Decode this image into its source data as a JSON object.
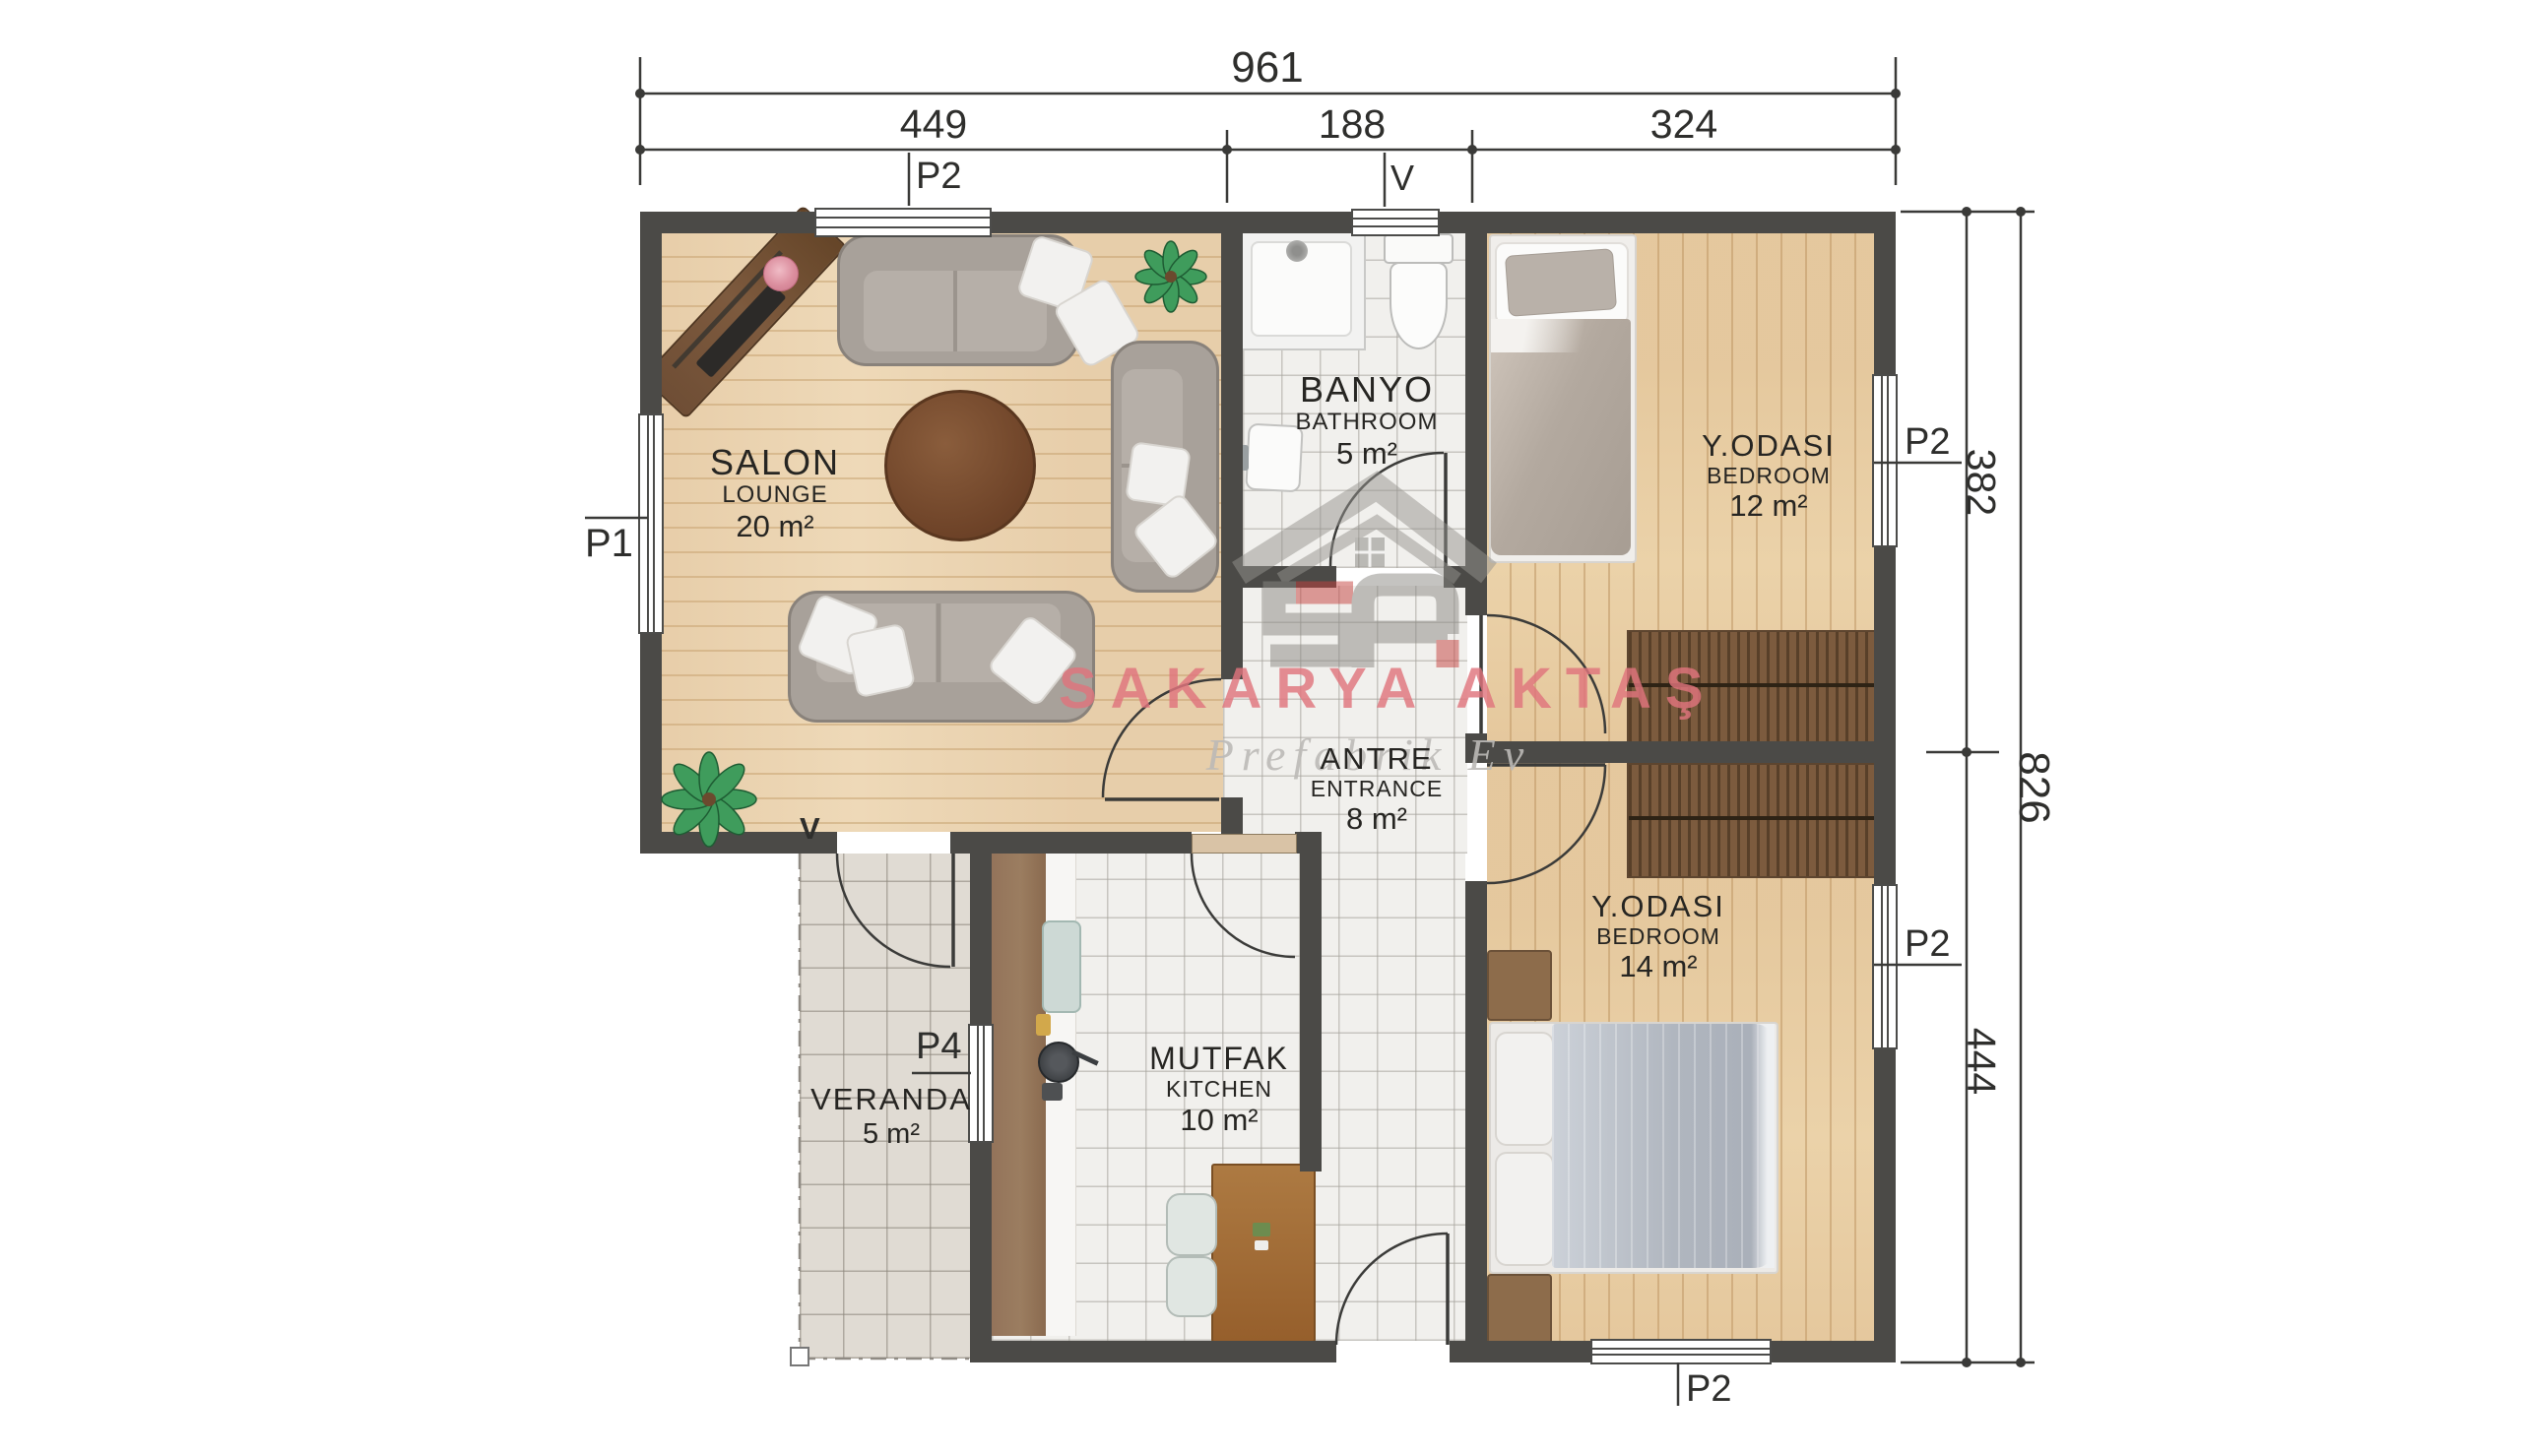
{
  "dimensions": {
    "width_total": "961",
    "width_segments": [
      "449",
      "188",
      "324"
    ],
    "height_total": "826",
    "height_segments": [
      "382",
      "444"
    ]
  },
  "rooms": [
    {
      "name": "SALON",
      "name_en": "LOUNGE",
      "area": "20 m²"
    },
    {
      "name": "BANYO",
      "name_en": "BATHROOM",
      "area": "5 m²"
    },
    {
      "name": "Y.ODASI",
      "name_en": "BEDROOM",
      "area": "12 m²"
    },
    {
      "name": "ANTRE",
      "name_en": "ENTRANCE",
      "area": "8 m²"
    },
    {
      "name": "MUTFAK",
      "name_en": "KITCHEN",
      "area": "10 m²"
    },
    {
      "name": "Y.ODASI",
      "name_en": "BEDROOM",
      "area": "14 m²"
    },
    {
      "name": "VERANDA",
      "area": "5 m²"
    }
  ],
  "opening_labels": {
    "p2_top": "P2",
    "v_top": "V",
    "p1_left": "P1",
    "p2_right_upper": "P2",
    "p2_right_lower": "P2",
    "p4_kitchen": "P4",
    "v_veranda": "V",
    "p2_bottom": "P2"
  },
  "watermark": {
    "brand": "SAKARYA AKTAŞ",
    "tagline": "Prefabrik Ev"
  },
  "colors": {
    "wall": "#4b4a47",
    "wood": "#e8d2ae",
    "tile": "#f1f0ee",
    "watermark_pink": "#e0747c",
    "logo_red": "#c5413e"
  }
}
